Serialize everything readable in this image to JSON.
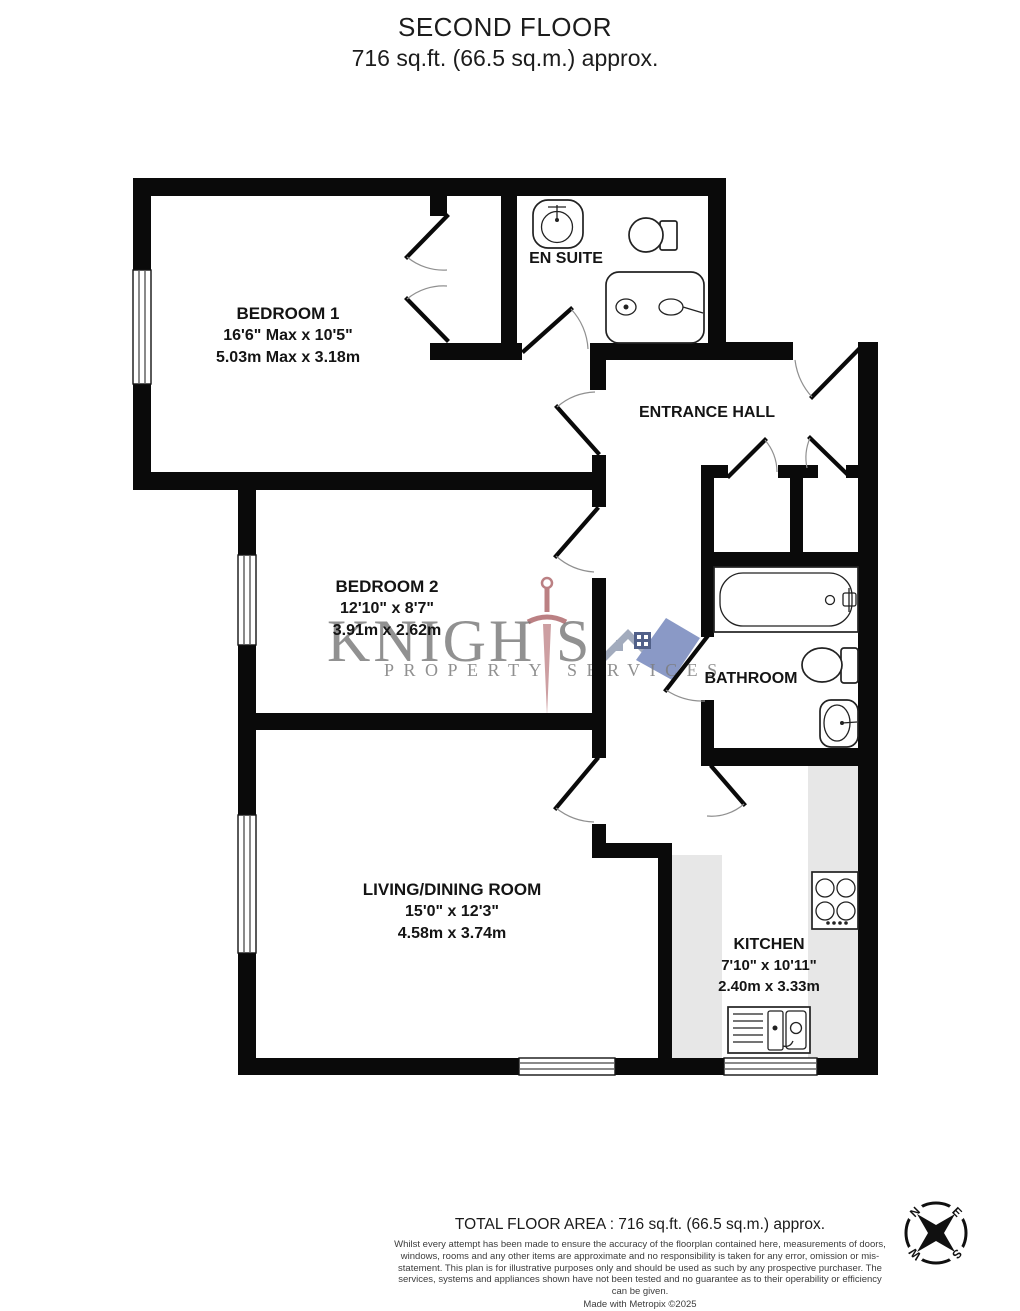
{
  "title": {
    "line1": "SECOND FLOOR",
    "line2": "716 sq.ft. (66.5 sq.m.) approx."
  },
  "rooms": {
    "bedroom1": {
      "name": "BEDROOM 1",
      "imperial": "16'6\" Max x 10'5\"",
      "metric": "5.03m Max x 3.18m"
    },
    "ensuite": {
      "name": "EN SUITE"
    },
    "hall": {
      "name": "ENTRANCE HALL"
    },
    "bedroom2": {
      "name": "BEDROOM 2",
      "imperial": "12'10\" x 8'7\"",
      "metric": "3.91m x 2.62m"
    },
    "bathroom": {
      "name": "BATHROOM"
    },
    "living": {
      "name": "LIVING/DINING ROOM",
      "imperial": "15'0\" x 12'3\"",
      "metric": "4.58m x 3.74m"
    },
    "kitchen": {
      "name": "KITCHEN",
      "imperial": "7'10\" x 10'11\"",
      "metric": "2.40m x 3.33m"
    }
  },
  "watermark": {
    "brand_part1": "KNIGH",
    "brand_part2": "S",
    "sub_left": "PROPERTY",
    "sub_right": "SERVICES"
  },
  "compass": {
    "n": "N",
    "e": "E",
    "s": "S",
    "w": "W"
  },
  "footer": {
    "total": "TOTAL FLOOR AREA : 716 sq.ft. (66.5 sq.m.) approx.",
    "disclaimer": "Whilst every attempt has been made to ensure the accuracy of the floorplan contained here, measurements of doors, windows, rooms and any other items are approximate and no responsibility is taken for any error, omission or mis-statement. This plan is for illustrative purposes only and should be used as such by any prospective purchaser. The services, systems and appliances shown have not been tested and no guarantee as to their operability or efficiency can be given.",
    "credit": "Made with Metropix ©2025"
  },
  "colors": {
    "wall": "#0a0a0a",
    "counter": "#e7e7e7",
    "wm-gray": "#7a7a7a",
    "wm-red": "#b06a6e",
    "wm-blue": "#7e8fc0",
    "wm-blue-dark": "#3f4f7d",
    "wm-steel": "#99a2b6"
  }
}
